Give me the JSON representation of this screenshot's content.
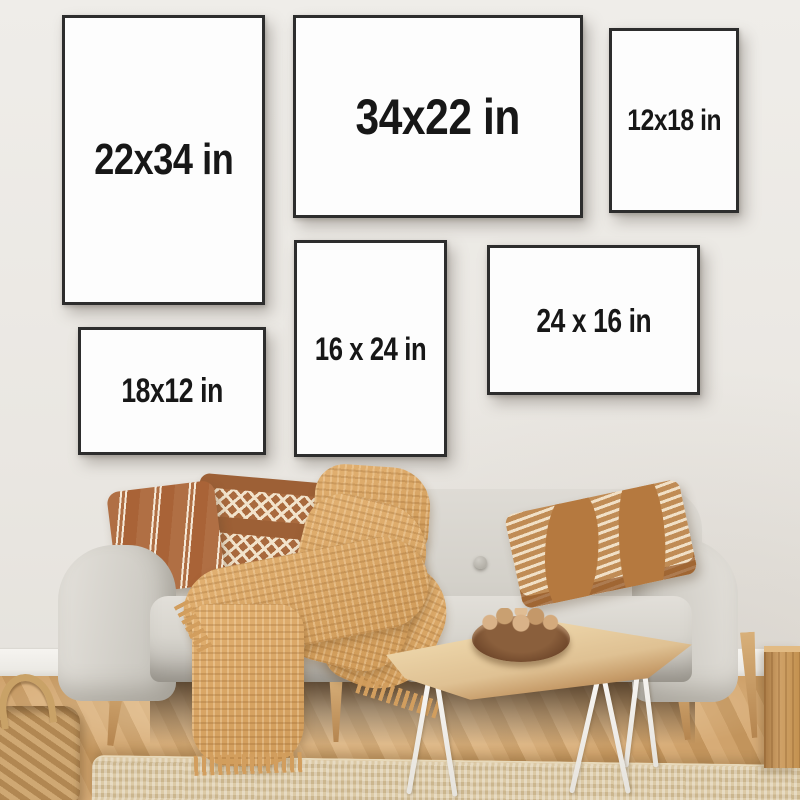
{
  "scene": {
    "type": "living-room product photograph",
    "description": "Six black poster frames with printed size labels hang on a pale wall above a light gray sofa styled with terracotta pillows and a mustard waffle-knit throw; in front sit a live-edge coffee table with hairpin legs and a bowl of walnuts, a jute rug, a woven basket and a herringbone wood floor.",
    "palette": {
      "wall": "#ebe8e4",
      "baseboard": "#f4f2ee",
      "frame_border": "#2d2d2d",
      "frame_matte": "#fdfdfd",
      "label_text": "#171717",
      "sofa_fabric": "#d7d4ce",
      "sofa_shadow": "#c2bfb8",
      "pillow_terracotta": "#b06f44",
      "pillow_brown": "#9d6036",
      "pillow_pattern_cream": "#f2e3cb",
      "pillow_tan": "#c08c55",
      "blanket": "#d9a566",
      "floor_wood": "#c9995f",
      "rug_jute": "#d9c8a6",
      "table_wood": "#e3c496",
      "hairpin_leg_white": "#f6f4f1",
      "bowl_wood": "#6e462a",
      "basket": "#c2986a",
      "wood_block": "#c99a62"
    },
    "objects": [
      "poster-frames",
      "sofa",
      "striped-pillow",
      "diamond-pillow",
      "chevron-pillow",
      "throw-blanket",
      "coffee-table",
      "nut-bowl",
      "jute-rug",
      "woven-basket",
      "wood-block",
      "herringbone-floor"
    ]
  },
  "frames": [
    {
      "label": "22x34 in",
      "orientation": "portrait"
    },
    {
      "label": "34x22 in",
      "orientation": "landscape"
    },
    {
      "label": "12x18 in",
      "orientation": "portrait"
    },
    {
      "label": "18x12 in",
      "orientation": "landscape"
    },
    {
      "label": "16 x 24 in",
      "orientation": "portrait"
    },
    {
      "label": "24 x 16 in",
      "orientation": "landscape"
    }
  ]
}
